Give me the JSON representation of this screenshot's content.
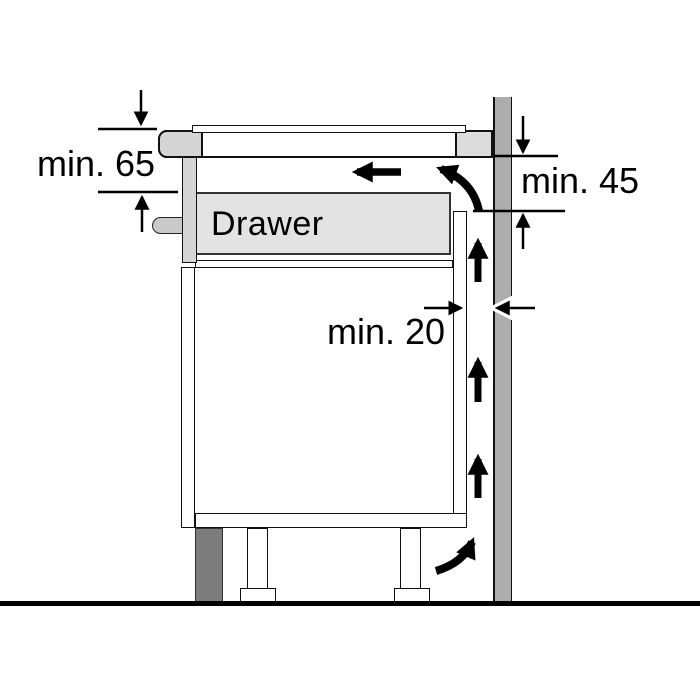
{
  "diagram": {
    "type": "appliance-installation-clearance-diagram",
    "labels": {
      "drawer": "Drawer",
      "min65": "min. 65",
      "min45": "min. 45",
      "min20": "min. 20"
    },
    "dimensions": [
      {
        "name": "hob-to-drawer-clearance",
        "value": "min. 65",
        "orientation": "vertical",
        "location": "left of hob"
      },
      {
        "name": "worktop-to-air-outlet-clearance",
        "value": "min. 45",
        "orientation": "vertical",
        "location": "right of wall"
      },
      {
        "name": "cabinet-back-to-wall-gap",
        "value": "min. 20",
        "orientation": "horizontal",
        "location": "between cabinet back panel and wall"
      }
    ],
    "airflow_arrows": [
      "left-arrow-under-hob",
      "curved-arrow-top-gap-to-left",
      "up-arrow-in-gap-1",
      "up-arrow-in-gap-2",
      "up-arrow-in-gap-3",
      "curved-arrow-bottom-into-gap"
    ],
    "colors": {
      "background": "#ffffff",
      "line": "#111111",
      "wall": "#adadad",
      "plinth": "#7c7c7c",
      "drawer_body": "#e3e3e3",
      "panel_gray": "#d5d5d5",
      "hob_right": "#dcdcdc",
      "knob": "#c9c9c9"
    }
  }
}
